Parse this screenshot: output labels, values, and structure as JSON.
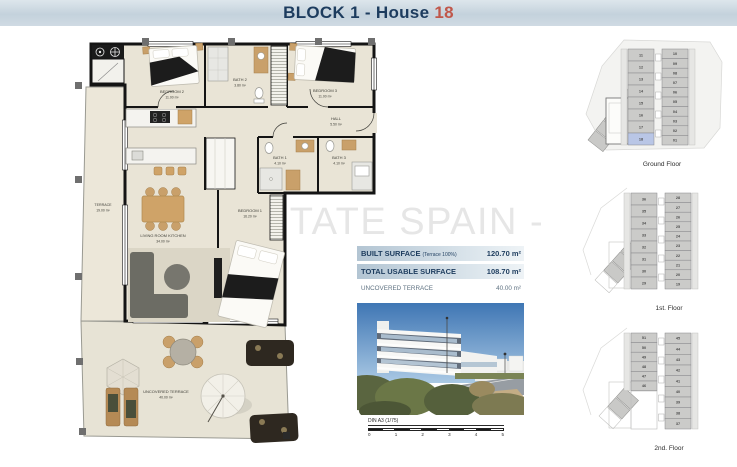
{
  "header": {
    "title_prefix": "BLOCK 1 - House",
    "house_number": "18"
  },
  "watermark": "ESTATE SPAIN -",
  "colors": {
    "navy": "#1d3c5e",
    "accent_red": "#c0574a",
    "highlight_blue": "#b9c6e6"
  },
  "floor_plan": {
    "rooms": [
      {
        "name": "BEDROOM 2",
        "area": "11.00 m²"
      },
      {
        "name": "BATH 2",
        "area": "3.80 m²"
      },
      {
        "name": "BEDROOM 3",
        "area": "11.00 m²"
      },
      {
        "name": "HALL",
        "area": "5.50 m²"
      },
      {
        "name": "BATH 1",
        "area": "4.10 m²"
      },
      {
        "name": "BATH 3",
        "area": "4.10 m²"
      },
      {
        "name": "TERRACE",
        "area": "19.00 m²"
      },
      {
        "name": "LIVING ROOM KITCHEN",
        "area": "34.00 m²"
      },
      {
        "name": "BEDROOM 1",
        "area": "16.20 m²"
      },
      {
        "name": "UNCOVERED TERRACE",
        "area": "40.00 m²"
      }
    ]
  },
  "surface_table": {
    "rows": [
      {
        "label": "BUILT SURFACE",
        "note": "(Terrace 100%)",
        "value": "120.70 m²",
        "emphasized": true
      },
      {
        "label": "TOTAL USABLE SURFACE",
        "note": "",
        "value": "108.70 m²",
        "emphasized": true
      },
      {
        "label": "UNCOVERED TERRACE",
        "note": "",
        "value": "40.00 m²",
        "emphasized": false
      }
    ]
  },
  "scale_bar": {
    "label": "DIN A3 (1/75)",
    "ticks": [
      "0",
      "1",
      "2",
      "3",
      "4",
      "5"
    ]
  },
  "site_plans": [
    {
      "label": "Ground Floor",
      "left_units": [
        "11",
        "12",
        "13",
        "14",
        "15",
        "16",
        "17",
        "18"
      ],
      "right_units": [
        "10",
        "09",
        "08",
        "07",
        "06",
        "05",
        "04",
        "03",
        "02",
        "01"
      ],
      "highlight_unit": "18"
    },
    {
      "label": "1st. Floor",
      "left_units": [
        "36",
        "35",
        "34",
        "33",
        "32",
        "31",
        "30",
        "29"
      ],
      "right_units": [
        "28",
        "27",
        "26",
        "25",
        "24",
        "23",
        "22",
        "21",
        "20",
        "19"
      ],
      "highlight_unit": ""
    },
    {
      "label": "2nd. Floor",
      "left_units": [
        "51",
        "50",
        "49",
        "48",
        "47",
        "46"
      ],
      "right_units": [
        "45",
        "44",
        "43",
        "42",
        "41",
        "40",
        "39",
        "38",
        "37"
      ],
      "highlight_unit": ""
    }
  ]
}
